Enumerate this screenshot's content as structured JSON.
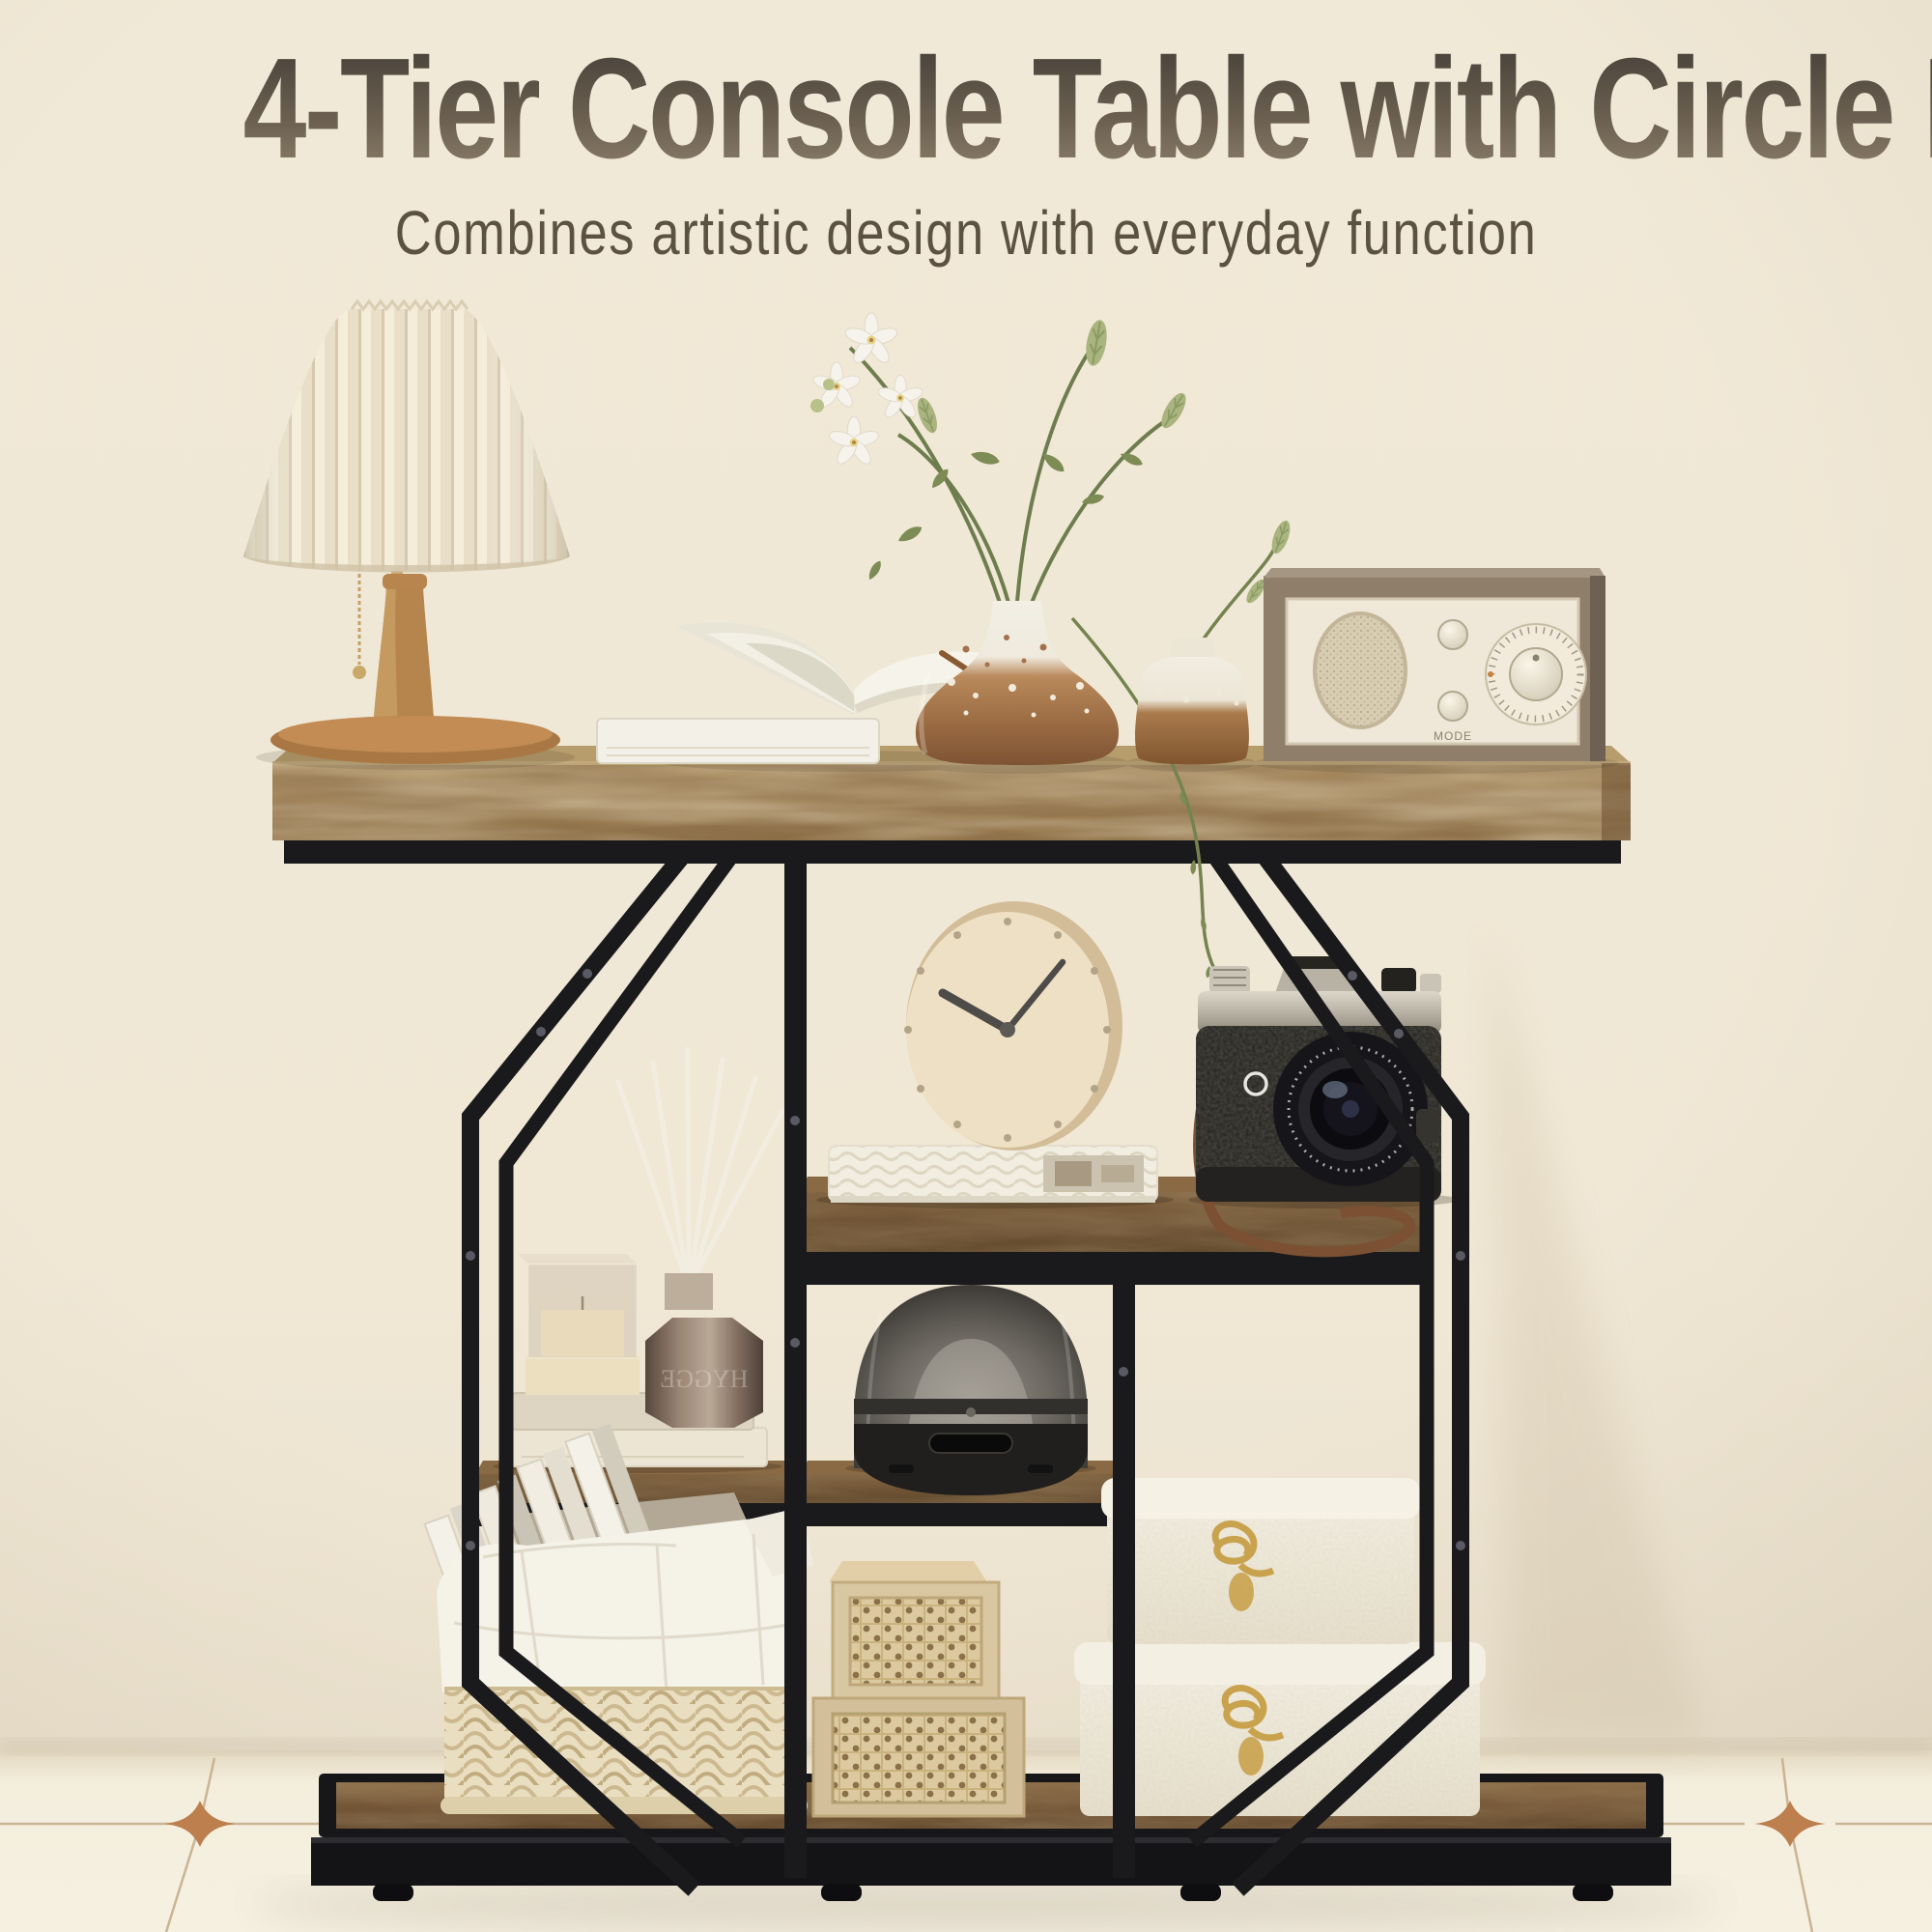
{
  "page": {
    "title": "4-Tier Console Table with Circle Base",
    "subtitle": "Combines artistic design with everyday function"
  },
  "palette": {
    "wall": "#ece4d2",
    "floor": "#f4eede",
    "grout_copper": "#bc7f4d",
    "metal_black": "#1a1a1d",
    "tabletop_wood": "#9b7f58",
    "shelf_wood": "#6e5335",
    "cream": "#f3ecdc",
    "title_gradient_top": "#443e37",
    "title_gradient_bottom": "#94856f",
    "subtitle_color": "#5c5242",
    "gold_hardware": "#c9a24e"
  },
  "scene": {
    "radio": {
      "mode_label": "MODE"
    },
    "diffuser_bottle": {
      "label": "HYGGE"
    },
    "items": [
      "pleated table lamp",
      "open books",
      "ceramic splatter vases with orchid",
      "retro radio",
      "desk clock",
      "vintage camera",
      "reed diffuser",
      "glass display box",
      "aroma diffuser",
      "woven storage basket",
      "rattan crates",
      "white leather boxes"
    ]
  }
}
